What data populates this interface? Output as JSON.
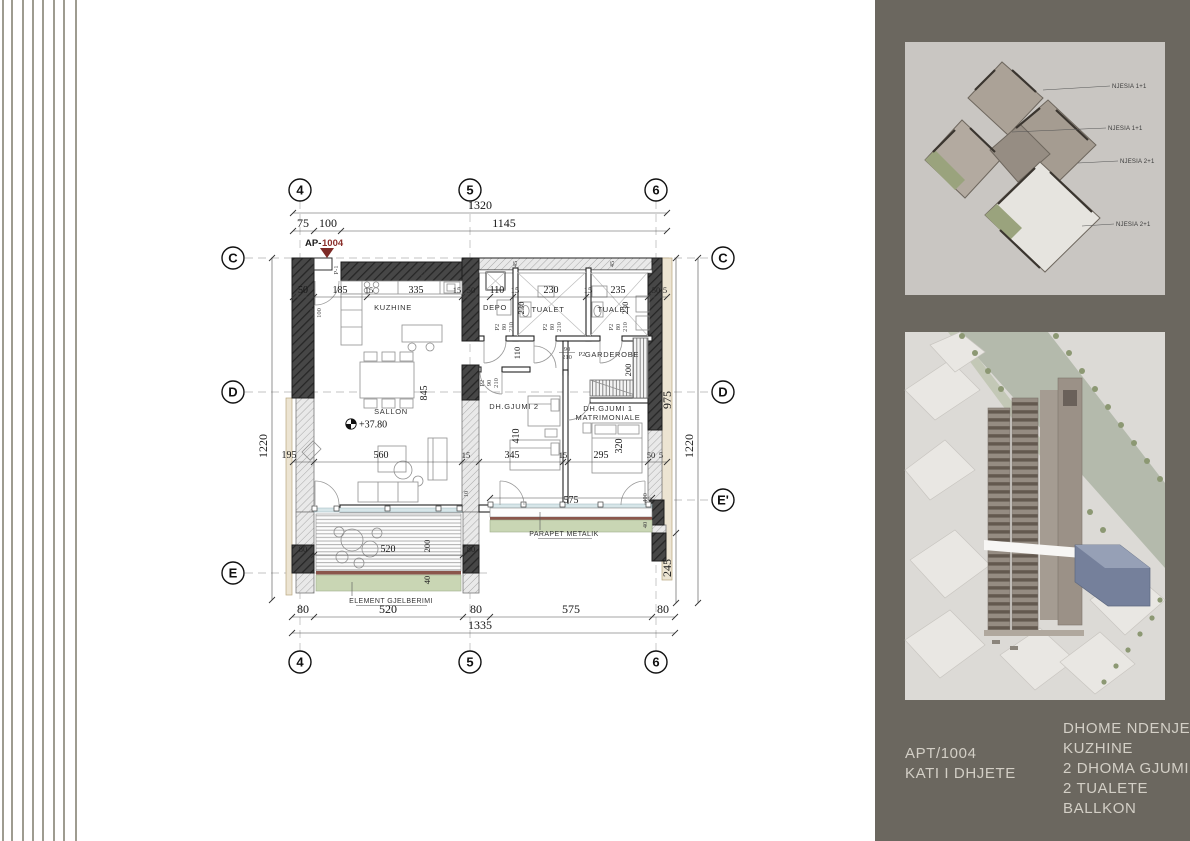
{
  "sidebar": {
    "bg": "#6b675f",
    "panel_bg": "#c9c6c2",
    "apartment_id": "APT/1004",
    "floor_label": "KATI I DHJETE",
    "program": [
      "DHOME NDENJE",
      "KUZHINE",
      "2 DHOMA GJUMI",
      "2 TUALETE",
      "BALLKON"
    ],
    "axon_labels": [
      "NJESIA 1+1",
      "NJESIA 1+1",
      "NJESIA 2+1",
      "NJESIA 2+1"
    ]
  },
  "plan": {
    "marker_prefix": "AP-",
    "marker_number": "1004",
    "marker_color": "#8b2f2b",
    "level": "+37.80",
    "grid": {
      "g4": "4",
      "g5": "5",
      "g6": "6",
      "gC": "C",
      "gD": "D",
      "gE": "E",
      "gEp": "E'"
    },
    "rooms": {
      "kitchen": "KUZHINE",
      "storage": "DEPO",
      "toilet1": "TUALET",
      "toilet2": "TUALET",
      "wardrobe": "GARDEROBE",
      "living": "SALLON",
      "bedroom2": "DH.GJUMI 2",
      "bedroom1a": "DH.GJUMI 1",
      "bedroom1b": "MATRIMONIALE"
    },
    "notes": {
      "parapet": "PARAPET METALIK",
      "greenery": "ELEMENT GJELBERIMI"
    },
    "doors": {
      "p1": "P-1",
      "p2": "P2"
    },
    "dims": {
      "1320": "1320",
      "1145": "1145",
      "75": "75",
      "100": "100",
      "1220": "1220",
      "975": "975",
      "245": "245",
      "1335": "1335",
      "50": "50",
      "5": "5",
      "185": "185",
      "15": "15",
      "335": "335",
      "110": "110",
      "230": "230",
      "235": "235",
      "150": "150",
      "45": "45",
      "845": "845",
      "195": "195",
      "560": "560",
      "345": "345",
      "295": "295",
      "410": "410",
      "320": "320",
      "200": "200",
      "520": "520",
      "80": "80",
      "575": "575",
      "40": "40",
      "400": "400",
      "10": "10",
      "90": "90",
      "210": "210"
    }
  }
}
